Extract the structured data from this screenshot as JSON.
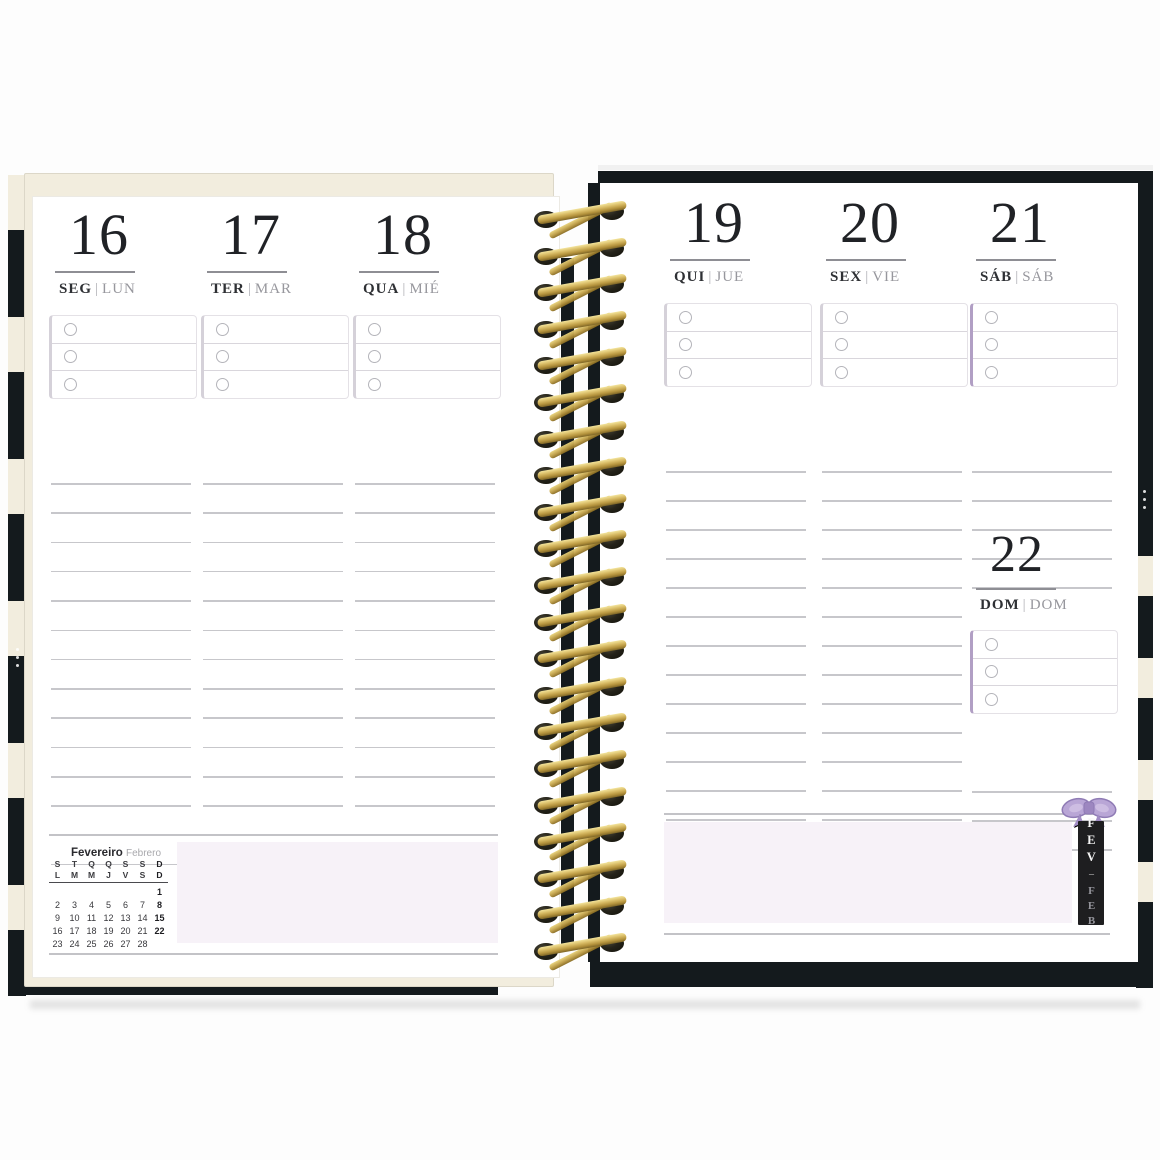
{
  "day_separator": "|",
  "left_page": {
    "days": [
      {
        "number": "16",
        "name_pt": "SEG",
        "name_es": "LUN"
      },
      {
        "number": "17",
        "name_pt": "TER",
        "name_es": "MAR"
      },
      {
        "number": "18",
        "name_pt": "QUA",
        "name_es": "MIÉ"
      }
    ],
    "mini_calendar": {
      "title_pt": "Fevereiro",
      "title_es": "Febrero",
      "weekday_rows": [
        [
          "S",
          "T",
          "Q",
          "Q",
          "S",
          "S",
          "D"
        ],
        [
          "L",
          "M",
          "M",
          "J",
          "V",
          "S",
          "D"
        ]
      ],
      "weeks": [
        [
          "",
          "",
          "",
          "",
          "",
          "",
          "1"
        ],
        [
          "2",
          "3",
          "4",
          "5",
          "6",
          "7",
          "8"
        ],
        [
          "9",
          "10",
          "11",
          "12",
          "13",
          "14",
          "15"
        ],
        [
          "16",
          "17",
          "18",
          "19",
          "20",
          "21",
          "22"
        ],
        [
          "23",
          "24",
          "25",
          "26",
          "27",
          "28",
          ""
        ]
      ]
    }
  },
  "right_page": {
    "days": [
      {
        "number": "19",
        "name_pt": "QUI",
        "name_es": "JUE"
      },
      {
        "number": "20",
        "name_pt": "SEX",
        "name_es": "VIE"
      },
      {
        "number": "21",
        "name_pt": "SÁB",
        "name_es": "SÁB"
      }
    ],
    "day_sunday": {
      "number": "22",
      "name_pt": "DOM",
      "name_es": "DOM"
    },
    "month_tab": {
      "pt": "FEV",
      "sep": "–",
      "es": "FEB"
    }
  },
  "colors": {
    "cover_black": "#141a1d",
    "cream_stripe": "#f2edde",
    "lavender_notes": "#f7f2f8",
    "accent_purple": "#b19fc4",
    "accent_gray": "#d5d1d9",
    "spiral_gold": "#c7a44e",
    "bow_lavender": "#b9a6d6"
  }
}
